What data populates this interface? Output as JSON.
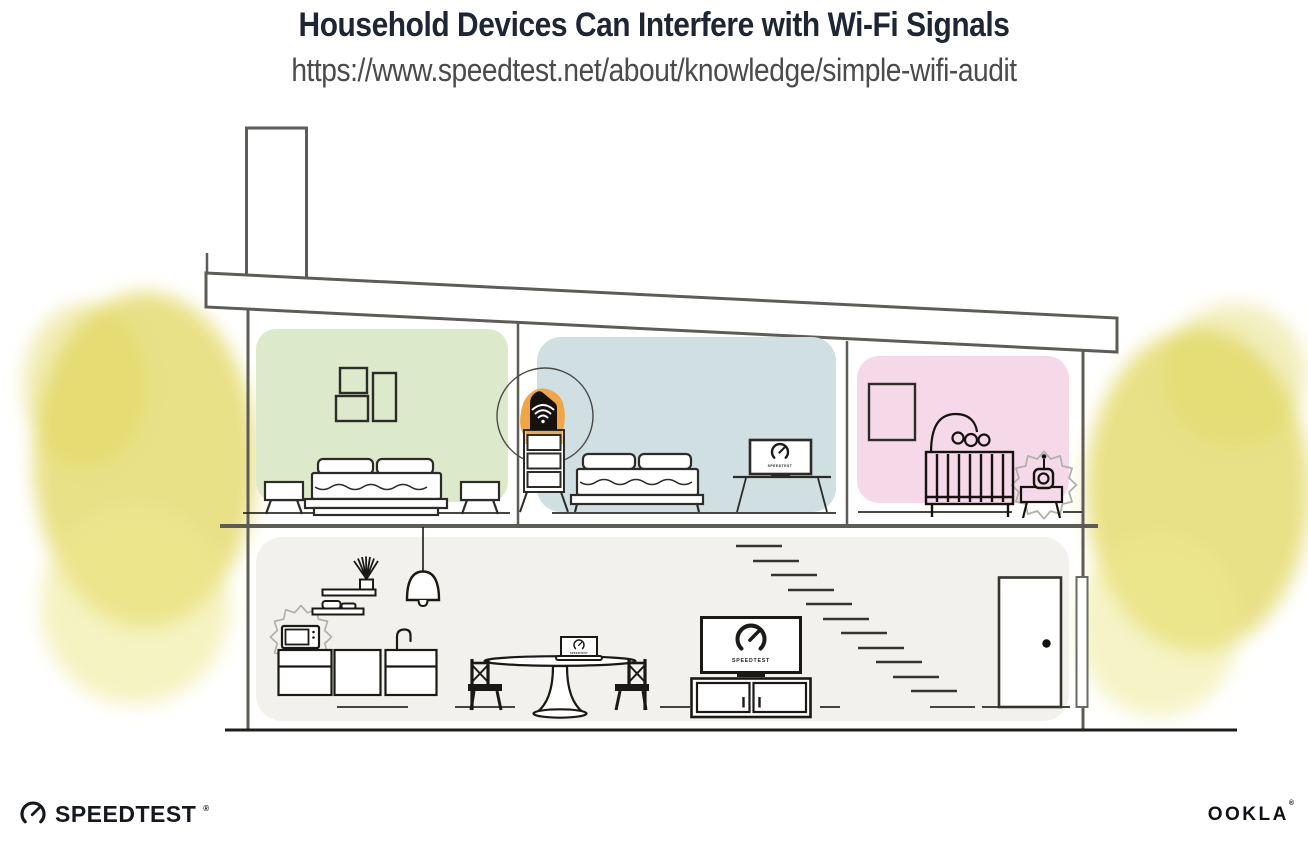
{
  "header": {
    "title": "Household Devices Can Interfere with Wi-Fi Signals",
    "url": "https://www.speedtest.net/about/knowledge/simple-wifi-audit"
  },
  "illustration": {
    "screens": {
      "living_tv": "SPEEDTEST",
      "bedroom_tv": "SPEEDTEST",
      "laptop": "SPEEDTEST"
    },
    "icons": [
      "wifi-router-icon",
      "speedtest-gauge-icon",
      "microwave-icon",
      "baby-monitor-icon",
      "interference-burst-icon"
    ],
    "colors": {
      "room_green": "#dde9cb",
      "room_blue": "#cfdfe2",
      "room_pink": "#f5d9e8",
      "room_gray": "#f2f1ee",
      "router_highlight_orange": "#f0a546",
      "foliage_yellow": "#e3da69",
      "line_dark": "#2b2b28",
      "wall_gray": "#5d5c56",
      "title_color": "#1e2633"
    }
  },
  "branding": {
    "speedtest_wordmark": "SPEEDTEST",
    "speedtest_reg": "®",
    "ookla_wordmark": "OOKLA",
    "ookla_reg": "®"
  }
}
